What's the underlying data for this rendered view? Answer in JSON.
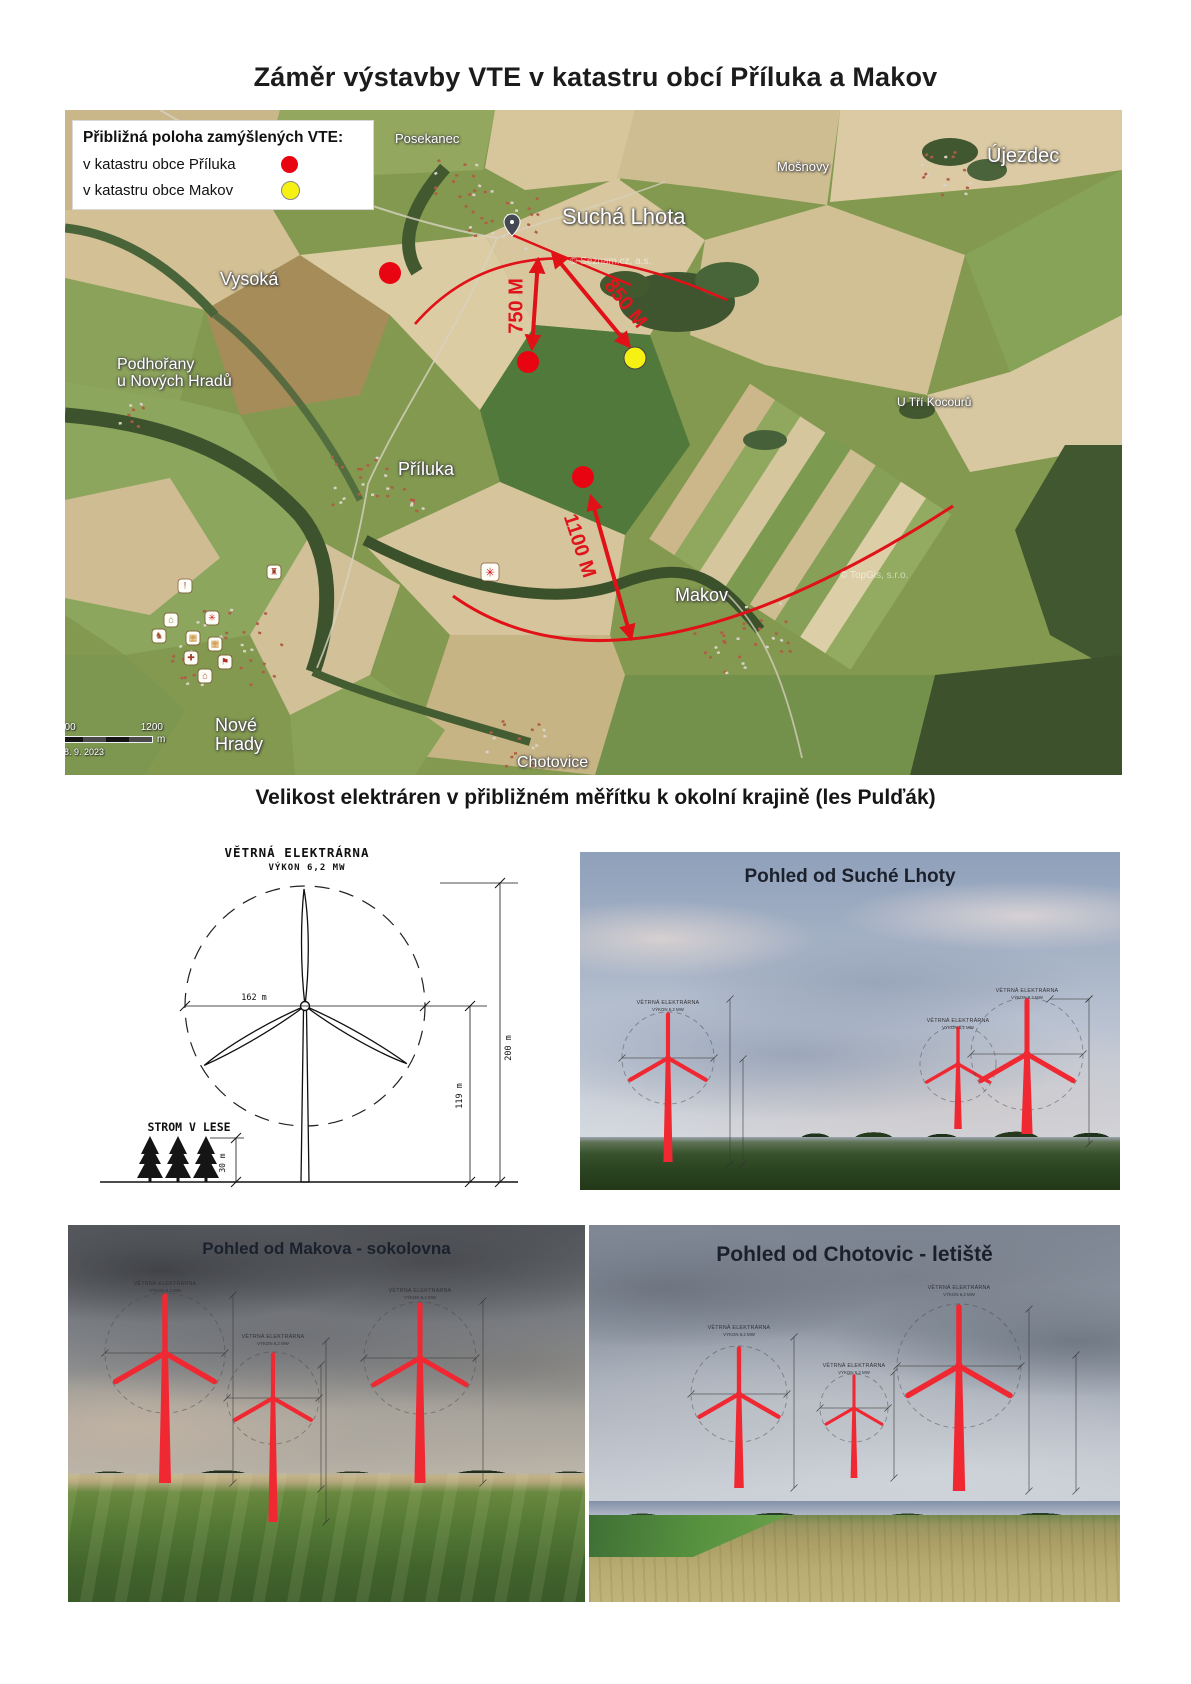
{
  "page": {
    "title": "Záměr výstavby VTE v katastru obcí Příluka a Makov",
    "section2_title": "Velikost elektráren v přibližném měřítku k okolní krajině (les Pulďák)"
  },
  "map": {
    "legend": {
      "title": "Přibližná poloha zamýšlených VTE:",
      "items": [
        {
          "label": "v katastru obce Příluka",
          "dot_color": "#e80410"
        },
        {
          "label": "v katastru obce Makov",
          "dot_color": "#f6f112"
        }
      ]
    },
    "place_labels": [
      {
        "text": "Posekanec",
        "x": 330,
        "y": 22,
        "size": 13
      },
      {
        "text": "Suchá Lhota",
        "x": 497,
        "y": 95,
        "size": 22
      },
      {
        "text": "Mošnovy",
        "x": 712,
        "y": 50,
        "size": 13
      },
      {
        "text": "Újezdec",
        "x": 922,
        "y": 36,
        "size": 20
      },
      {
        "text": "Vysoká",
        "x": 155,
        "y": 160,
        "size": 18
      },
      {
        "text": "Podhořany\nu Nových Hradů",
        "x": 52,
        "y": 246,
        "size": 16
      },
      {
        "text": "Příluka",
        "x": 333,
        "y": 350,
        "size": 18
      },
      {
        "text": "U Tří Kocourů",
        "x": 832,
        "y": 286,
        "size": 12
      },
      {
        "text": "Makov",
        "x": 610,
        "y": 476,
        "size": 18
      },
      {
        "text": "Nové\nHrady",
        "x": 150,
        "y": 606,
        "size": 18
      },
      {
        "text": "Chotovice",
        "x": 452,
        "y": 644,
        "size": 16
      }
    ],
    "watermarks": [
      {
        "text": "© Seznam.cz, a.s.",
        "x": 505,
        "y": 146
      },
      {
        "text": "© TopGis, s.r.o.",
        "x": 775,
        "y": 460
      }
    ],
    "dots": [
      {
        "x": 325,
        "y": 163,
        "d": 22,
        "color": "#e80410",
        "outline": false
      },
      {
        "x": 463,
        "y": 252,
        "d": 22,
        "color": "#e80410",
        "outline": false
      },
      {
        "x": 518,
        "y": 367,
        "d": 22,
        "color": "#e80410",
        "outline": false
      },
      {
        "x": 570,
        "y": 248,
        "d": 21,
        "color": "#f6f112",
        "outline": true
      }
    ],
    "distances": [
      {
        "text": "750 M",
        "x": 452,
        "y": 196,
        "rot": -90
      },
      {
        "text": "850 M",
        "x": 560,
        "y": 194,
        "rot": 52
      },
      {
        "text": "1100 M",
        "x": 514,
        "y": 436,
        "rot": 72
      }
    ],
    "poi": [
      {
        "name": "warning-icon",
        "glyph": "!",
        "x": 120,
        "y": 476,
        "color": "#b03028"
      },
      {
        "name": "mill-asterisk-icon",
        "glyph": "✳",
        "x": 147,
        "y": 508,
        "color": "#d01818"
      },
      {
        "name": "homestead-icon",
        "glyph": "⌂",
        "x": 106,
        "y": 510,
        "color": "#8d6e3a"
      },
      {
        "name": "museum-icon",
        "glyph": "▦",
        "x": 128,
        "y": 528,
        "color": "#c8862a"
      },
      {
        "name": "museum-icon",
        "glyph": "▦",
        "x": 150,
        "y": 534,
        "color": "#c8862a"
      },
      {
        "name": "horse-icon",
        "glyph": "♞",
        "x": 94,
        "y": 526,
        "color": "#a0522d"
      },
      {
        "name": "castle-icon",
        "glyph": "♜",
        "x": 209,
        "y": 462,
        "color": "#a03a2a"
      },
      {
        "name": "maze-icon",
        "glyph": "⚑",
        "x": 160,
        "y": 552,
        "color": "#b03028"
      },
      {
        "name": "factory-icon",
        "glyph": "⌂",
        "x": 140,
        "y": 566,
        "color": "#a03a2a"
      },
      {
        "name": "chapel-icon",
        "glyph": "✚",
        "x": 126,
        "y": 548,
        "color": "#a03a2a"
      },
      {
        "name": "red-asterisk-marker",
        "glyph": "✳",
        "x": 425,
        "y": 462,
        "color": "#d01212"
      }
    ],
    "scale_bar": {
      "start": "600",
      "end": "1200",
      "unit": "m",
      "date": "18. 9. 2023"
    }
  },
  "drawing": {
    "title": "VĚTRNÁ ELEKTRÁRNA",
    "subtitle": "VÝKON 6,2 MW",
    "rotor_diameter": "162 m",
    "total_height": "200 m",
    "hub_height": "119 m",
    "tree_height": "30 m",
    "tree_label": "STROM V LESE"
  },
  "turbine_annotation": {
    "line1": "VĚTRNÁ ELEKTRÁRNA",
    "line2": "VÝKON 6,2 MW"
  },
  "photos": [
    {
      "id": "sucha-lhota",
      "title": "Pohled od Suché Lhoty",
      "turbines": [
        {
          "x": 88,
          "base": 310,
          "hub": 206,
          "r": 46,
          "ax": 88,
          "ay": 152
        },
        {
          "x": 378,
          "base": 277,
          "hub": 212,
          "r": 38,
          "ax": 378,
          "ay": 170
        },
        {
          "x": 447,
          "base": 282,
          "hub": 202,
          "r": 56,
          "ax": 447,
          "ay": 140
        }
      ],
      "dim_lines": [
        [
          150,
          147,
          150,
          312
        ],
        [
          163,
          207,
          163,
          312
        ],
        [
          42,
          206,
          134,
          206
        ],
        [
          391,
          202,
          503,
          202
        ],
        [
          509,
          147,
          509,
          292
        ],
        [
          470,
          147,
          509,
          147
        ]
      ]
    },
    {
      "id": "makov",
      "title": "Pohled od Makova - sokolovna",
      "turbines": [
        {
          "x": 97,
          "base": 258,
          "hub": 128,
          "r": 60,
          "ax": 97,
          "ay": 60
        },
        {
          "x": 205,
          "base": 297,
          "hub": 173,
          "r": 46,
          "ax": 205,
          "ay": 113
        },
        {
          "x": 352,
          "base": 258,
          "hub": 133,
          "r": 56,
          "ax": 352,
          "ay": 67
        }
      ],
      "dim_lines": [
        [
          37,
          128,
          157,
          128
        ],
        [
          165,
          70,
          165,
          258
        ],
        [
          159,
          173,
          251,
          173
        ],
        [
          258,
          116,
          258,
          297
        ],
        [
          296,
          133,
          408,
          133
        ],
        [
          415,
          76,
          415,
          258
        ],
        [
          253,
          140,
          253,
          264
        ]
      ]
    },
    {
      "id": "chotovice",
      "title": "Pohled od Chotovic - letiště",
      "turbines": [
        {
          "x": 150,
          "base": 263,
          "hub": 169,
          "r": 48,
          "ax": 150,
          "ay": 104
        },
        {
          "x": 265,
          "base": 253,
          "hub": 183,
          "r": 34,
          "ax": 265,
          "ay": 142
        },
        {
          "x": 370,
          "base": 266,
          "hub": 141,
          "r": 62,
          "ax": 370,
          "ay": 64
        }
      ],
      "dim_lines": [
        [
          102,
          169,
          198,
          169
        ],
        [
          205,
          112,
          205,
          263
        ],
        [
          231,
          183,
          299,
          183
        ],
        [
          305,
          147,
          305,
          253
        ],
        [
          308,
          141,
          432,
          141
        ],
        [
          440,
          84,
          440,
          266
        ],
        [
          487,
          130,
          487,
          266
        ]
      ]
    }
  ],
  "colors": {
    "turbine_red": "#ef2832",
    "map_accent_red": "#e01117"
  }
}
